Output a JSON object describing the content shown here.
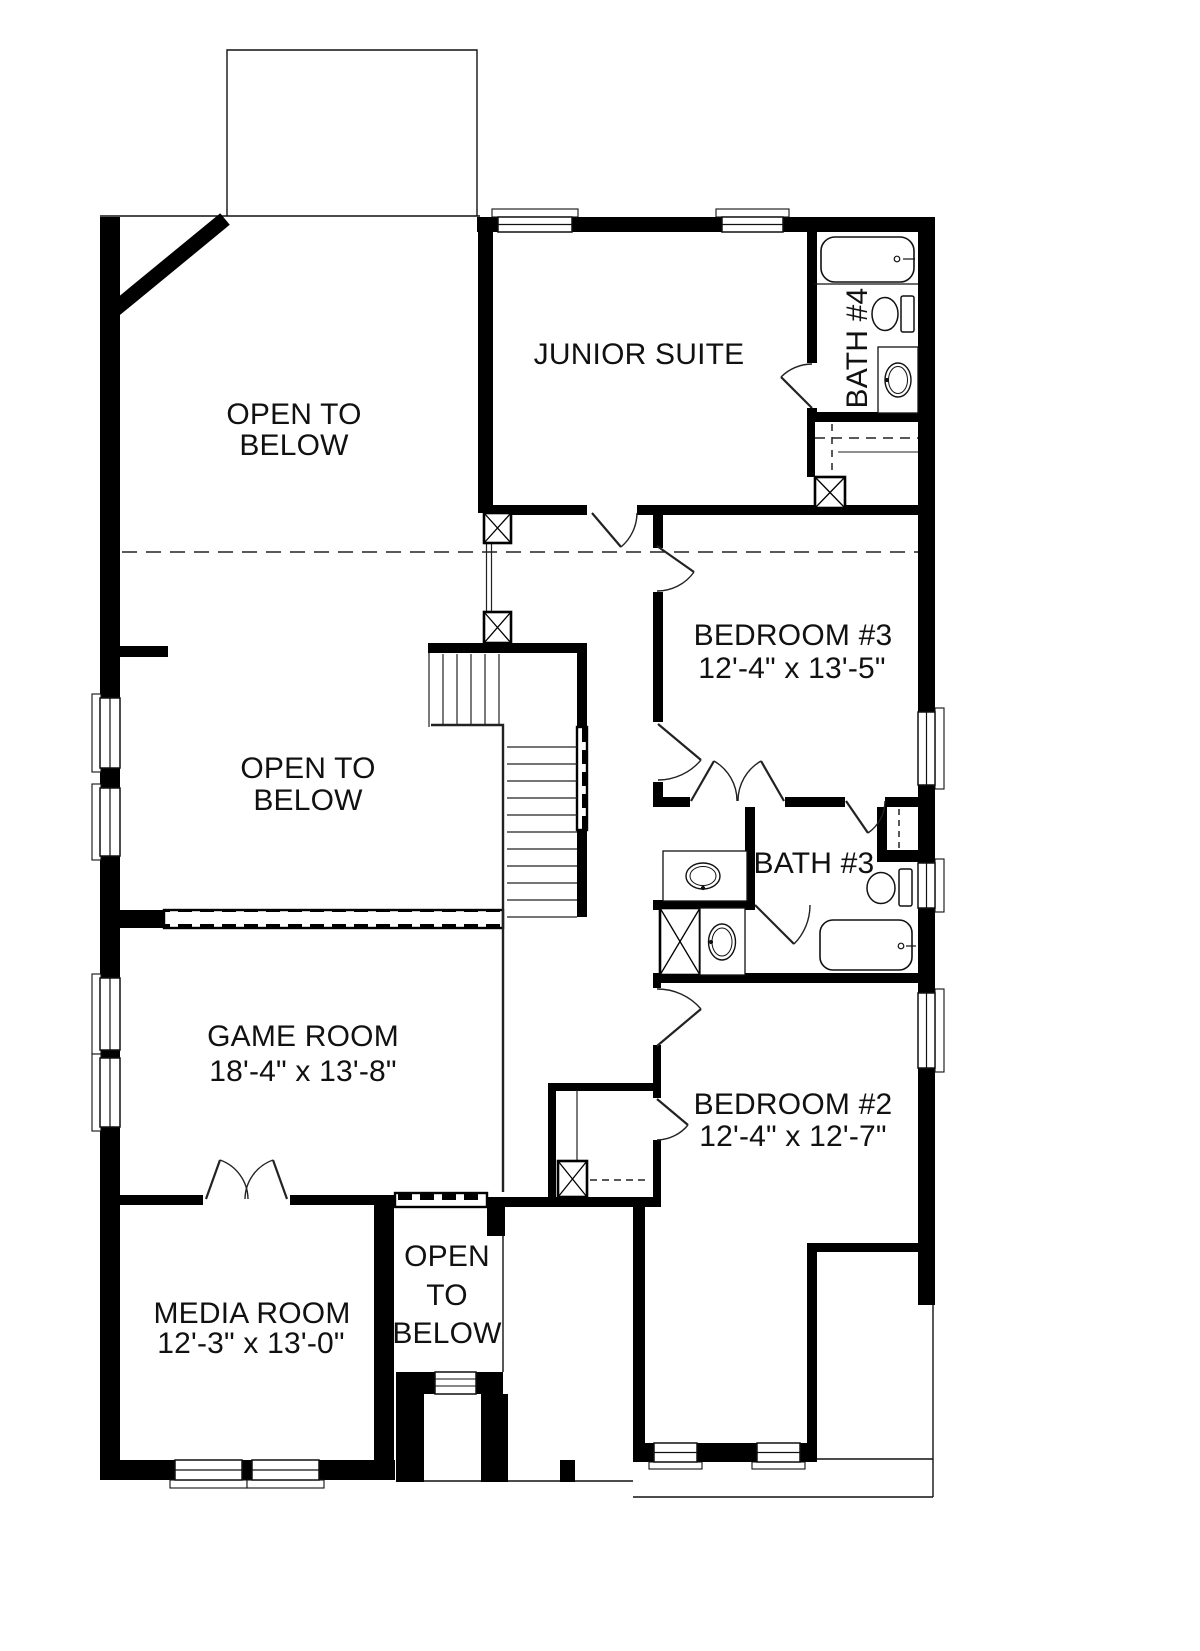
{
  "rooms": {
    "open_to_below_upper": {
      "line1": "OPEN TO",
      "line2": "BELOW"
    },
    "junior_suite": {
      "name": "JUNIOR SUITE"
    },
    "bath_4": {
      "name": "BATH #4"
    },
    "bedroom_3": {
      "name": "BEDROOM #3",
      "dims": "12'-4\" x 13'-5\""
    },
    "open_to_below_middle": {
      "line1": "OPEN TO",
      "line2": "BELOW"
    },
    "bath_3": {
      "name": "BATH #3"
    },
    "game_room": {
      "name": "GAME ROOM",
      "dims": "18'-4\" x 13'-8\""
    },
    "bedroom_2": {
      "name": "BEDROOM #2",
      "dims": "12'-4\" x 12'-7\""
    },
    "media_room": {
      "name": "MEDIA ROOM",
      "dims": "12'-3\" x 13'-0\""
    },
    "open_to_below_lower": {
      "line1": "OPEN",
      "line2": "TO",
      "line3": "BELOW"
    }
  },
  "fixtures": [
    "bathtub",
    "toilet",
    "sink",
    "shower",
    "vanity"
  ],
  "features": [
    "stairs",
    "railing",
    "windows",
    "doors",
    "chases"
  ],
  "colors": {
    "wall": "#000000",
    "background": "#ffffff",
    "text": "#111111"
  }
}
